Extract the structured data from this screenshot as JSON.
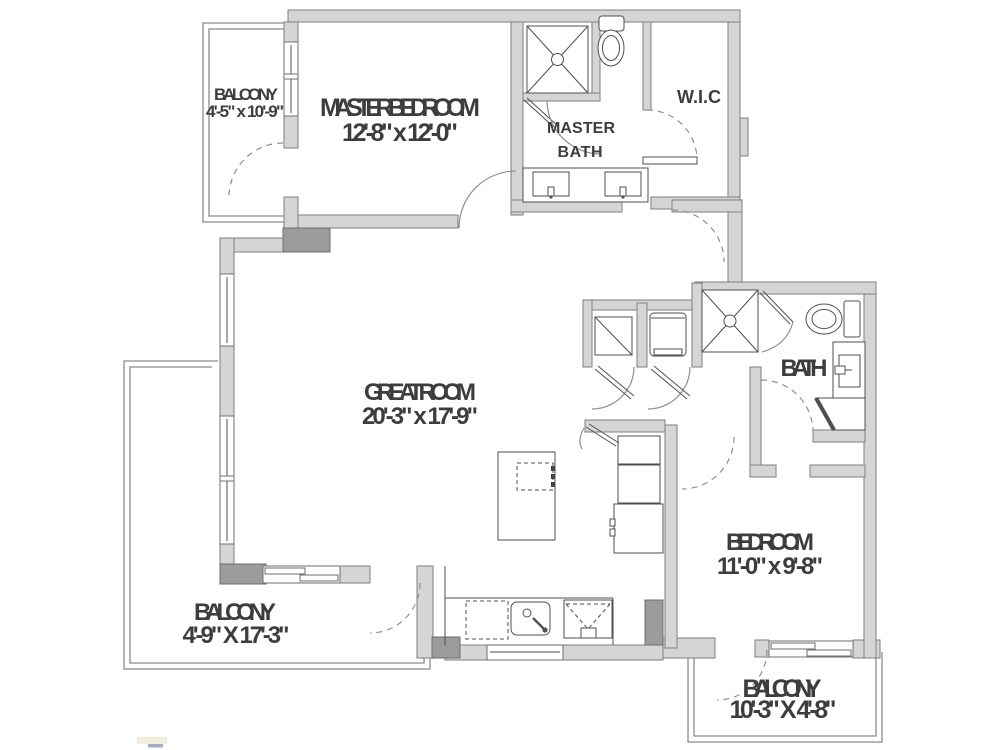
{
  "floor_plan": {
    "rooms": {
      "balcony_top_left": {
        "name": "BALCONY",
        "dims": "4'-5\" x 10'-9\""
      },
      "master_bedroom": {
        "name": "MASTER BEDROOM",
        "dims": "12'-8\" x 12'-0\""
      },
      "master_bath": {
        "line1": "MASTER",
        "line2": "BATH"
      },
      "wic": {
        "name": "W.I.C"
      },
      "great_room": {
        "name": "GREAT ROOM",
        "dims": "20'-3\" x 17'-9\""
      },
      "bath": {
        "name": "BATH"
      },
      "bedroom": {
        "name": "BEDROOM",
        "dims": "11'-0\" x 9'-8\""
      },
      "balcony_bottom_left": {
        "name": "BALCONY",
        "dims": "4'-9\" X 17'-3\""
      },
      "balcony_bottom_right": {
        "name": "BALCONY",
        "dims": "10'-3\" X 4'-8\""
      }
    },
    "colors": {
      "wall_fill": "#d5d5d5",
      "wall_stroke": "#7e7e7e",
      "column_fill": "#9b9b9b",
      "fixture_line": "#4f4f4f",
      "door_arc": "#8f8f8f",
      "label_text": "#3d3d3d"
    }
  }
}
